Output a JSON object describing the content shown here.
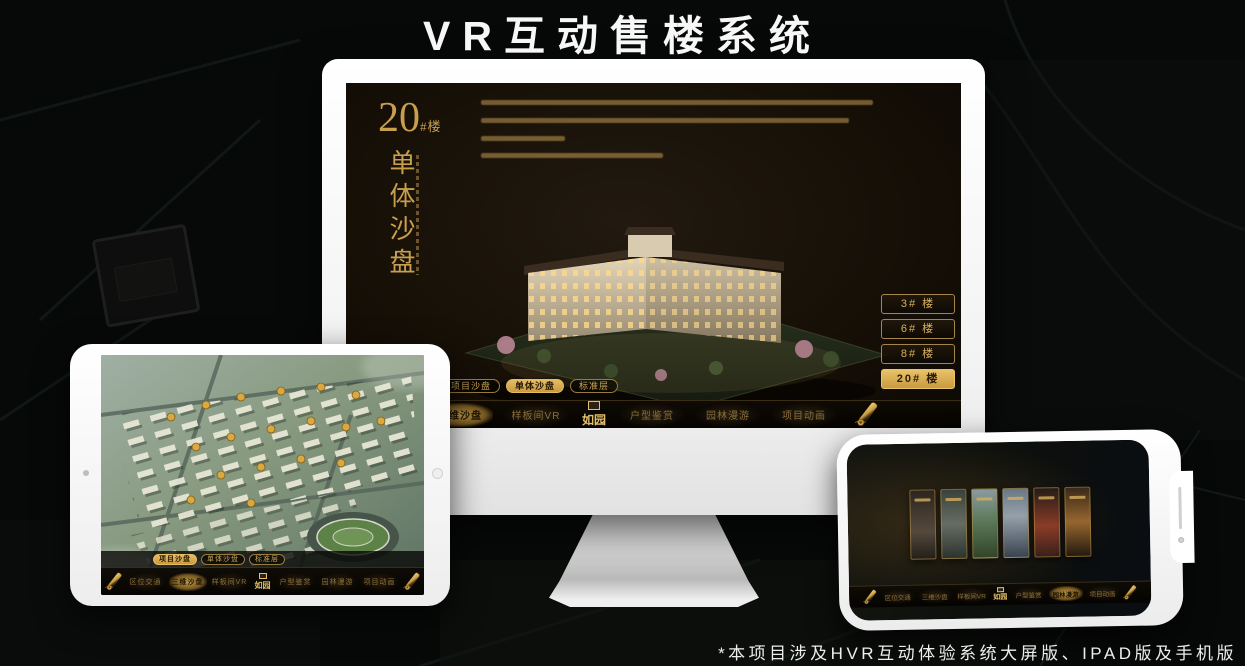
{
  "page": {
    "title": "VR互动售楼系统",
    "footnote": "*本项目涉及HVR互动体验系统大屏版、IPAD版及手机版"
  },
  "colors": {
    "gold": "#cda351",
    "gold_active": "#d8ab52",
    "screen_dark": "#171007",
    "device_white": "#ffffff"
  },
  "monitor": {
    "block_panel": {
      "number": "20",
      "suffix": "#楼",
      "vertical_label": "单体沙盘"
    },
    "building_buttons": [
      {
        "label": "3# 楼"
      },
      {
        "label": "6# 楼"
      },
      {
        "label": "8# 楼"
      },
      {
        "label": "20# 楼"
      }
    ],
    "subtabs": [
      {
        "label": "项目沙盘"
      },
      {
        "label": "单体沙盘"
      },
      {
        "label": "标准层"
      }
    ],
    "nav": {
      "left": [
        {
          "label": "区位交通"
        },
        {
          "label": "三维沙盘"
        },
        {
          "label": "样板间VR"
        }
      ],
      "logo": "如园",
      "right": [
        {
          "label": "户型鉴赏"
        },
        {
          "label": "园林漫游"
        },
        {
          "label": "项目动画"
        }
      ]
    }
  },
  "tablet": {
    "subtabs": [
      {
        "label": "项目沙盘"
      },
      {
        "label": "单体沙盘"
      },
      {
        "label": "标准层"
      }
    ],
    "nav": {
      "left": [
        {
          "label": "区位交通"
        },
        {
          "label": "三维沙盘"
        },
        {
          "label": "样板间VR"
        }
      ],
      "logo": "如园",
      "right": [
        {
          "label": "户型鉴赏"
        },
        {
          "label": "园林漫游"
        },
        {
          "label": "项目动画"
        }
      ]
    }
  },
  "phone": {
    "nav": {
      "left": [
        {
          "label": "区位交通"
        },
        {
          "label": "三维沙盘"
        },
        {
          "label": "样板间VR"
        }
      ],
      "logo": "如园",
      "right": [
        {
          "label": "户型鉴赏"
        },
        {
          "label": "园林漫游"
        },
        {
          "label": "项目动画"
        }
      ]
    }
  }
}
